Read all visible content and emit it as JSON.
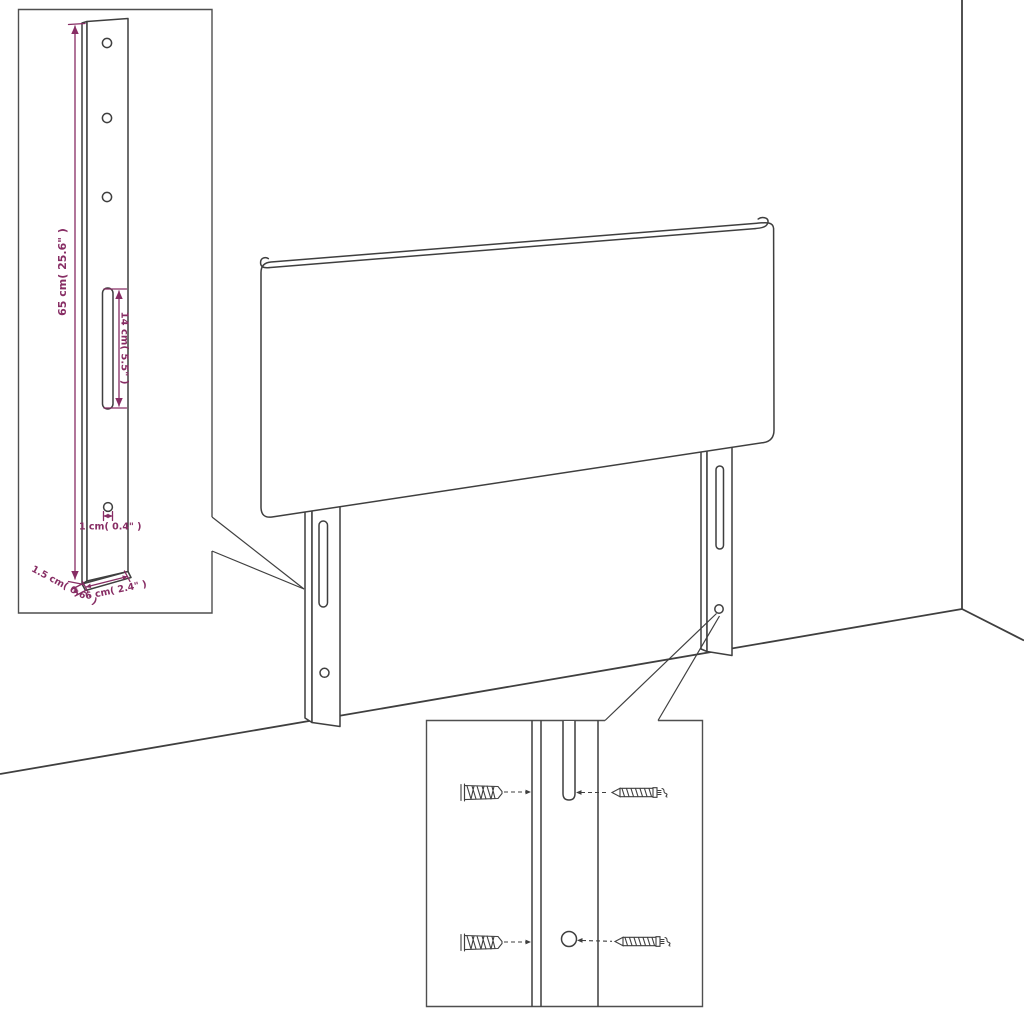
{
  "colors": {
    "line": "#3f3f3f",
    "dimension": "#872d64",
    "background": "#ffffff"
  },
  "icons": {
    "screw": "screw-icon",
    "wall_plug": "wall-plug-icon"
  },
  "bracket_inset": {
    "dim_height": "65 cm( 25.6\" )",
    "dim_slot_length": "14 cm( 5.5\" )",
    "dim_hole_diameter": "1 cm( 0.4\" )",
    "dim_thickness": "1.5 cm( 0.6\" )",
    "dim_width": "6 cm( 2.4\" )"
  }
}
